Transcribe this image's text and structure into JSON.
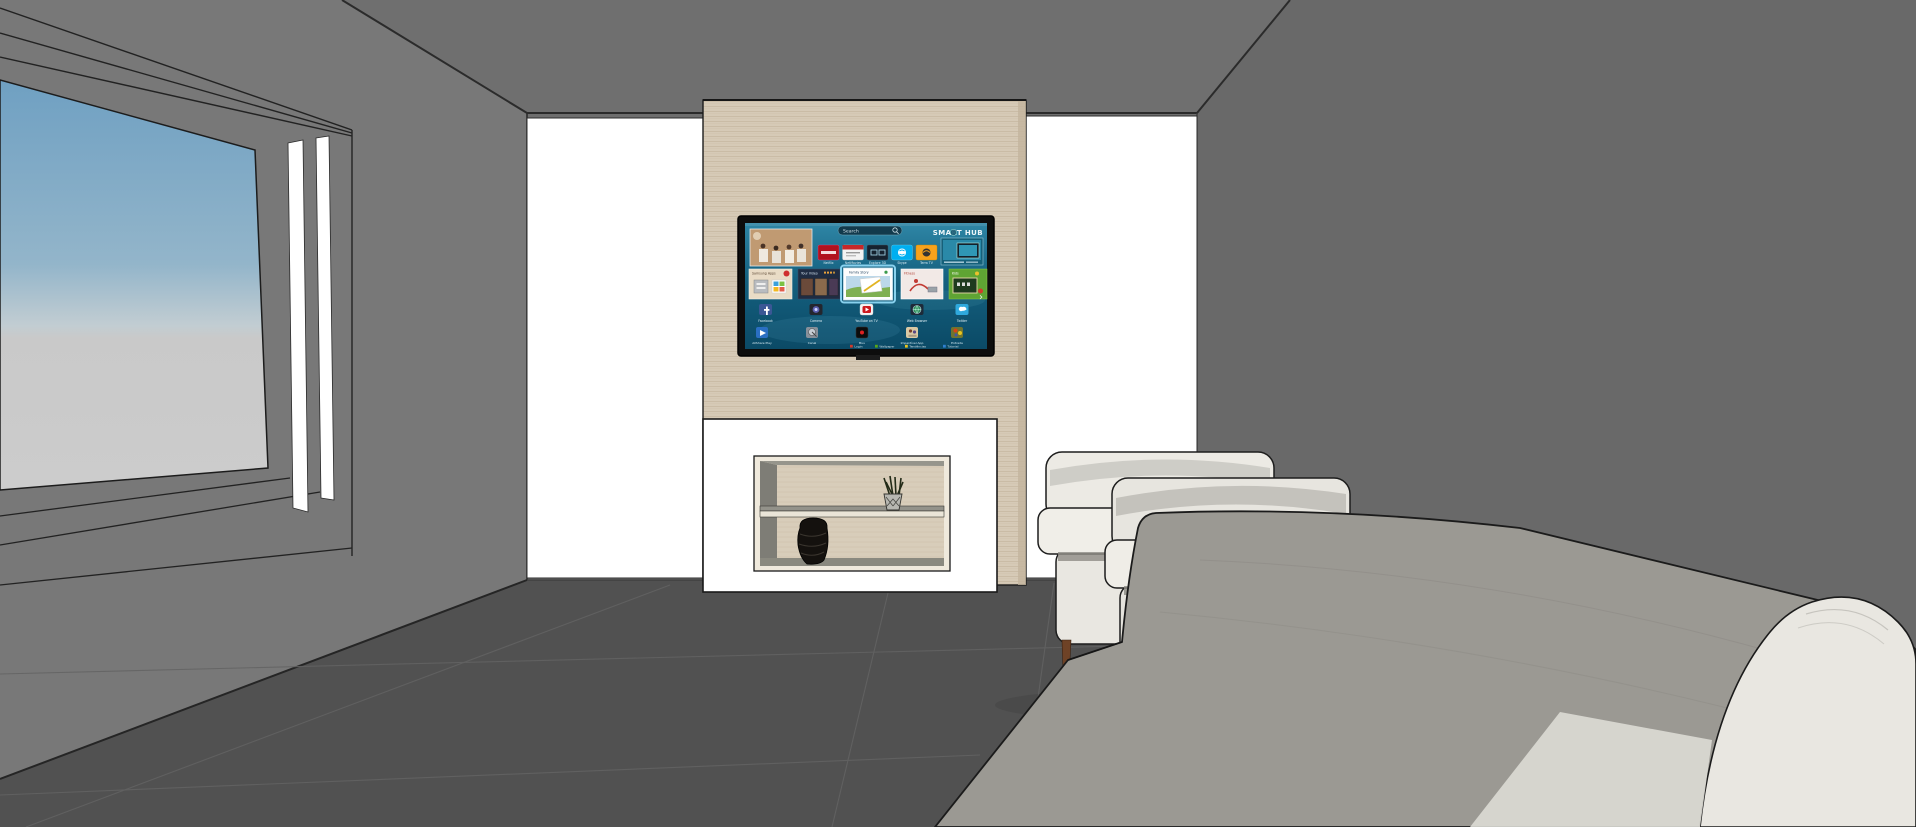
{
  "scene_title": "Living room 3D render",
  "colors": {
    "ceiling": "#6f6f6f",
    "back_wall": "#6e6e6e",
    "right_wall": "#696969",
    "window_wall": "#787878",
    "floor": "#515151",
    "floor_seam": "#636363",
    "white_wall": "#ffffff",
    "wood_panel": "#d6cab7",
    "wood_grain": "#bcab92",
    "niche_frame": "#efe9dc",
    "niche_back": "#d8cdba",
    "tv_bezel": "#0d0d0d",
    "screen_water_top": "#2f86a6",
    "screen_water_bottom": "#0b4a66",
    "sky_top": "#6fa0c2",
    "sky_horizon": "#c2cdd2",
    "sky_ground": "#c9c9c9",
    "chair_fabric": "#eceae4",
    "leg_wood": "#6e4226",
    "sofa_gray": "#9b9993",
    "sofa_ivory": "#e9e7e1",
    "selected_tile_glow": "#8fd8f4"
  },
  "tv": {
    "search_placeholder": "Search",
    "brand": "SMART HUB",
    "selected_tile": "Family Story",
    "top_apps": [
      "Netflix",
      "NetMovies",
      "Explore 3D",
      "Skype",
      "Terra TV"
    ],
    "feature_tiles": [
      "Samsung Apps",
      "Your Video",
      "Family Story",
      "Fitness",
      "Kids"
    ],
    "app_row_1": [
      "Facebook",
      "Camera",
      "YouTube on TV",
      "Web Browser",
      "Twitter"
    ],
    "app_row_2": [
      "AllShare Play",
      "Canal",
      "Muu",
      "Imperdível App",
      "Entrada"
    ],
    "footer_keys": [
      {
        "label": "Login",
        "color": "#d03a2b"
      },
      {
        "label": "Wallpaper",
        "color": "#58a618"
      },
      {
        "label": "Tendências",
        "color": "#e8c51e"
      },
      {
        "label": "Tutorial",
        "color": "#2f7fd0"
      }
    ],
    "pagination_next": "›"
  }
}
